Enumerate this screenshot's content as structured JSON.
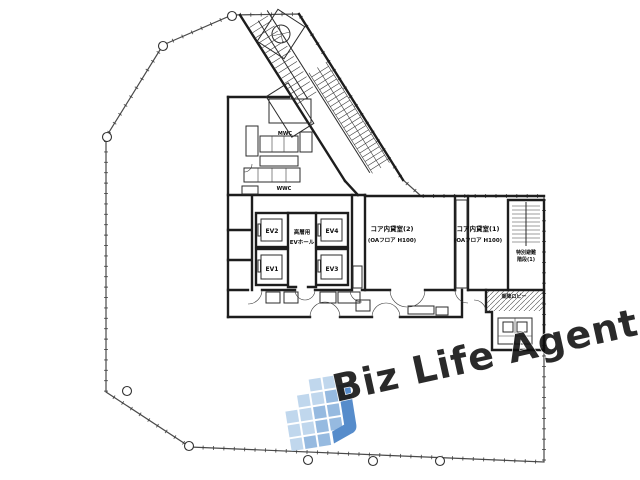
{
  "plan": {
    "background": "#ffffff",
    "line_color": "#1d1d1d",
    "rooms": {
      "ev1": "EV1",
      "ev2": "EV2",
      "ev3": "EV3",
      "ev4": "EV4",
      "ev_hall_line1": "高層用",
      "ev_hall_line2": "EVホール",
      "core_room2_name": "コア内貸室(2)",
      "core_room2_spec": "(OAフロア H100)",
      "core_room1_name": "コア内貸室(1)",
      "core_room1_spec": "(OAフロア H100)",
      "mens_wc": "MWC",
      "womens_wc": "WWC",
      "emergency_stair_line1": "特別避難",
      "emergency_stair_line2": "階段(1)",
      "ev_lobby": "乗降ロビー"
    }
  },
  "watermark": {
    "text": "Biz Life Agent",
    "text_color": "#9c9c9c",
    "logo_colors": {
      "light": "#bcd4ec",
      "mid": "#8fb5de",
      "dark": "#4a84c8"
    }
  }
}
